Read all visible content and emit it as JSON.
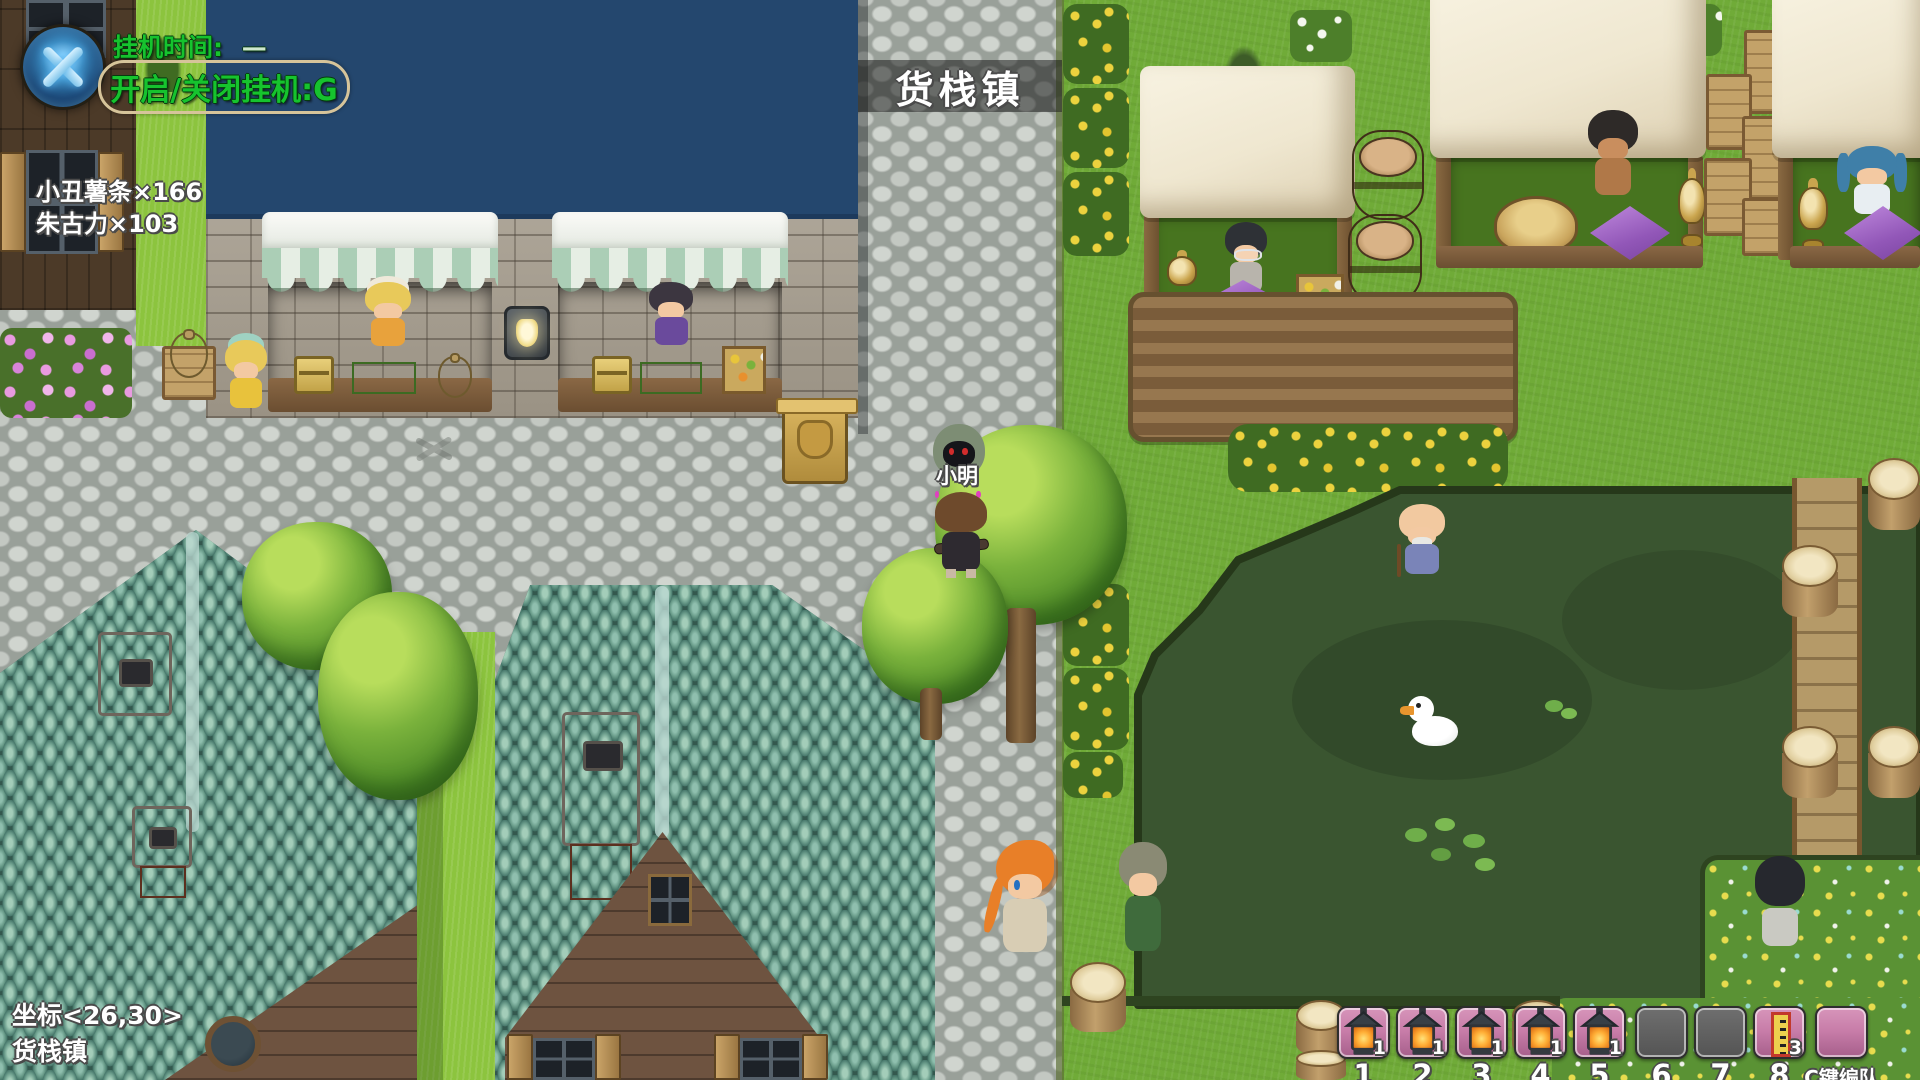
{
  "hud": {
    "afk_widget": {
      "time_label": "挂机时间:",
      "time_value": "—",
      "toggle_hint": "开启/关闭挂机:G"
    },
    "item_counters": [
      {
        "label": "小丑薯条×166"
      },
      {
        "label": "朱古力×103"
      }
    ],
    "town_banner": {
      "text": "货栈镇"
    },
    "nameplate": {
      "text": "小明"
    },
    "position_readout": {
      "coords": "坐标<26,30>",
      "map_name": "货栈镇"
    },
    "hotbar": {
      "party_hint": "C键编队",
      "slots": [
        {
          "key": "1",
          "item": "lantern",
          "count": "1",
          "state": "filled"
        },
        {
          "key": "2",
          "item": "lantern",
          "count": "1",
          "state": "filled"
        },
        {
          "key": "3",
          "item": "lantern",
          "count": "1",
          "state": "filled"
        },
        {
          "key": "4",
          "item": "lantern",
          "count": "1",
          "state": "filled"
        },
        {
          "key": "5",
          "item": "lantern",
          "count": "1",
          "state": "filled"
        },
        {
          "key": "6",
          "item": "",
          "count": "",
          "state": "empty-gray"
        },
        {
          "key": "7",
          "item": "",
          "count": "",
          "state": "empty-gray"
        },
        {
          "key": "8",
          "item": "talisman",
          "count": "3",
          "state": "filled"
        },
        {
          "key": "",
          "item": "",
          "count": "",
          "state": "empty-pink"
        }
      ]
    },
    "colors": {
      "hud_green": "#16c32e",
      "slot_pink": "#c77ca8",
      "slot_gray": "#5e5e5e",
      "banner_bg": "rgba(22,22,22,0.52)"
    }
  }
}
